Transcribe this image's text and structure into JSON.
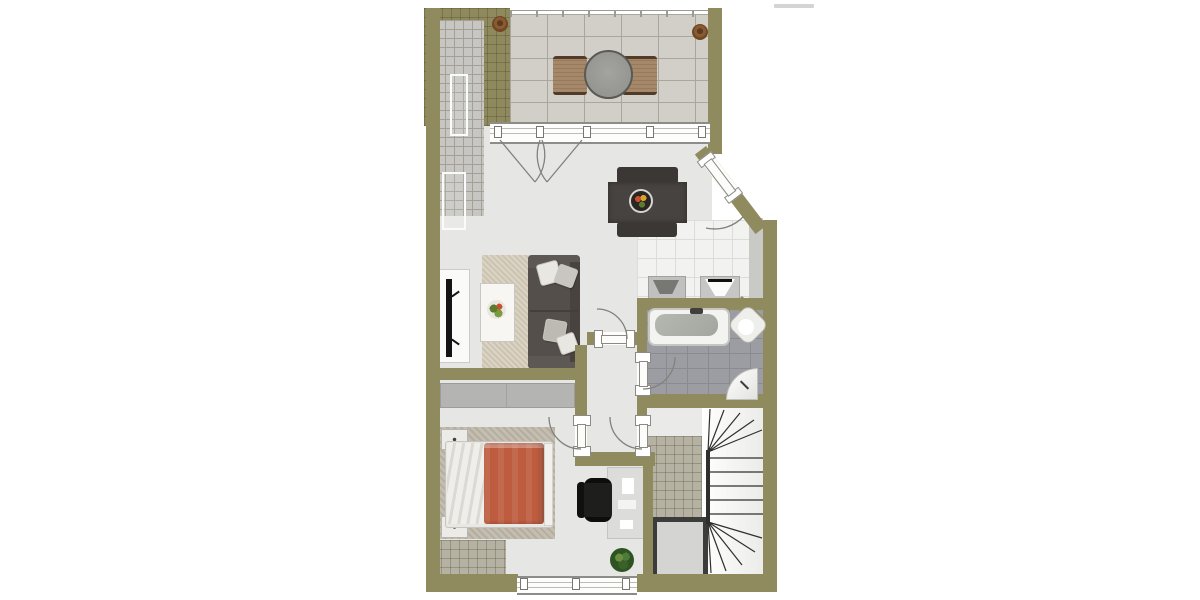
{
  "document": {
    "type": "3d-rendered-floor-plan",
    "background": "#ffffff",
    "watermark_text": "illegible"
  },
  "palette": {
    "wall": "#908b5f",
    "floor": "#e6e6e4",
    "terrace_stone": "#d2cfc9",
    "roof_hatch_gray": "#c7c6c2",
    "stair_hatch": "#b5b2a3",
    "kitchen_tile": "#f2f2f0",
    "bath_tile": "#9c9da2",
    "dining_table": "#474340",
    "outdoor_chair": "#a5886a",
    "sofa": "#544f4b",
    "living_rug": "#cdc4b0",
    "bed_duvet": "#bd5c3f",
    "bed_sheets": "#eceae5",
    "bed_rug": "#c4beb0",
    "wardrobe": "#b4b4b2",
    "office_chair": "#1d1d1c",
    "stair_line": "#2f2f2d",
    "door_arc": "#82827c",
    "plant_green": "#4e7b3a"
  },
  "plan": {
    "rooms": [
      {
        "id": "terrace",
        "furniture": [
          "railing",
          "outdoor-round-table",
          "outdoor-chair-left",
          "outdoor-chair-right",
          "plant-pot-left",
          "plant-pot-right"
        ]
      },
      {
        "id": "roof-slope-areas",
        "furniture": [
          "roof-window-upper",
          "roof-window-lower"
        ]
      },
      {
        "id": "living-room",
        "furniture": [
          "french-double-door",
          "dining-table",
          "dining-chair-top",
          "dining-chair-bottom",
          "fruit-bowl",
          "tv-sideboard",
          "tv",
          "area-rug",
          "coffee-table",
          "flower-arrangement",
          "corner-sofa",
          "sofa-pillows"
        ]
      },
      {
        "id": "kitchen",
        "furniture": [
          "kitchen-sink-unit",
          "wash-basin-unit"
        ]
      },
      {
        "id": "entrance",
        "furniture": [
          "entrance-door-diagonal"
        ]
      },
      {
        "id": "hallway",
        "furniture": [
          "door-to-living-room",
          "door-to-bathroom",
          "door-to-bedroom",
          "door-to-stairwell"
        ]
      },
      {
        "id": "bathroom",
        "furniture": [
          "bathtub",
          "corner-wash-basin",
          "corner-shower"
        ]
      },
      {
        "id": "bedroom",
        "furniture": [
          "wardrobe",
          "bed-rug",
          "double-bed",
          "duvet",
          "nightstand-top",
          "nightstand-bottom",
          "desk",
          "office-chair",
          "potted-plant",
          "south-window"
        ]
      },
      {
        "id": "stairwell",
        "furniture": [
          "winder-staircase",
          "shaft"
        ]
      }
    ]
  }
}
